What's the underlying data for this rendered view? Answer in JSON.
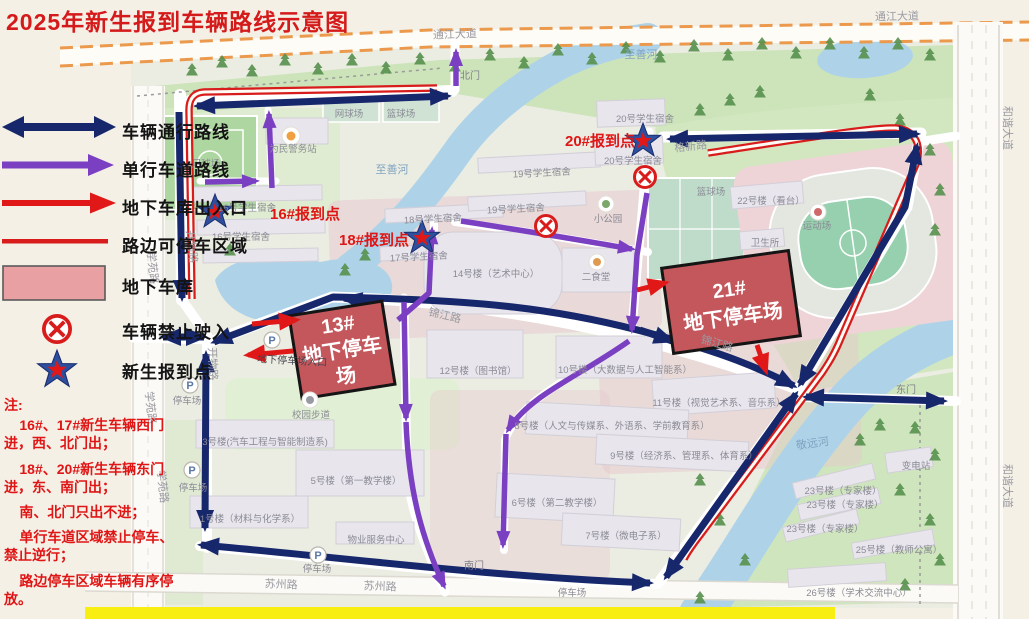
{
  "title": "2025年新生报到车辆路线示意图",
  "legend": {
    "items": [
      {
        "id": "two-way-route",
        "label": "车辆通行路线",
        "color": "#17276b"
      },
      {
        "id": "one-way-route",
        "label": "单行车道路线",
        "color": "#7b3fc2"
      },
      {
        "id": "garage-access",
        "label": "地下车库出入口",
        "color": "#e01818"
      },
      {
        "id": "roadside-parking",
        "label": "路边可停车区域",
        "color": "#d81c1c"
      },
      {
        "id": "underground-garage",
        "label": "地下车库",
        "color": "#e9a0a2"
      },
      {
        "id": "no-entry",
        "label": "车辆禁止驶入",
        "color": "#d81c1c"
      },
      {
        "id": "checkin-point",
        "label": "新生报到点",
        "color": "#2d4f9e"
      }
    ]
  },
  "notes": {
    "heading": "注:",
    "lines": [
      "16#、17#新生车辆西门进，西、北门出；",
      "18#、20#新生车辆东门进，东、南门出；",
      "南、北门只出不进；",
      "单行车道区域禁止停车、禁止逆行；",
      "路边停车区域车辆有序停放。"
    ]
  },
  "map": {
    "garages": [
      {
        "id": "garage-13",
        "lines": [
          "13#",
          "地下停车",
          "场"
        ],
        "x": 342,
        "y": 350,
        "rot": -9,
        "w": 94,
        "h": 84
      },
      {
        "id": "garage-21",
        "lines": [
          "21#",
          "地下停车场"
        ],
        "x": 731,
        "y": 302,
        "rot": -8,
        "w": 128,
        "h": 86
      }
    ],
    "checkin_stars": [
      {
        "id": "star-16",
        "x": 215,
        "y": 212
      },
      {
        "id": "star-18",
        "x": 422,
        "y": 238
      },
      {
        "id": "star-20",
        "x": 643,
        "y": 141
      }
    ],
    "no_entry": [
      {
        "id": "no-entry-1",
        "x": 546,
        "y": 226
      },
      {
        "id": "no-entry-2",
        "x": 645,
        "y": 177
      }
    ],
    "parking_icons": [
      [
        190,
        385
      ],
      [
        192,
        470
      ],
      [
        272,
        340
      ],
      [
        318,
        555
      ]
    ],
    "labels": [
      {
        "id": "road-tongjiang-1",
        "text": "通江大道",
        "x": 455,
        "y": 38,
        "rot": -2,
        "cls": "road"
      },
      {
        "id": "road-tongjiang-2",
        "text": "通江大道",
        "x": 897,
        "y": 20,
        "rot": -1,
        "cls": "road"
      },
      {
        "id": "road-hexie-1",
        "text": "和谐大道",
        "x": 1004,
        "y": 128,
        "rot": 90,
        "cls": "road"
      },
      {
        "id": "road-hexie-2",
        "text": "和谐大道",
        "x": 1004,
        "y": 486,
        "rot": 90,
        "cls": "road"
      },
      {
        "id": "road-xueyuan-1",
        "text": "学苑路",
        "x": 149,
        "y": 268,
        "rot": 84,
        "cls": "road"
      },
      {
        "id": "road-xueyuan-2",
        "text": "学苑路",
        "x": 147,
        "y": 408,
        "rot": 84,
        "cls": "road"
      },
      {
        "id": "road-xueyuan-3",
        "text": "学苑路",
        "x": 159,
        "y": 487,
        "rot": 84,
        "cls": "road"
      },
      {
        "id": "road-kaiwu-1",
        "text": "开物路",
        "x": 188,
        "y": 247,
        "rot": 84,
        "cls": "road"
      },
      {
        "id": "road-kaiwu-2",
        "text": "开物路",
        "x": 209,
        "y": 364,
        "rot": 88,
        "cls": "road"
      },
      {
        "id": "road-jinjiang-1",
        "text": "锦江路",
        "x": 444,
        "y": 319,
        "rot": 13,
        "cls": "road"
      },
      {
        "id": "road-jinjiang-2",
        "text": "锦江路",
        "x": 716,
        "y": 347,
        "rot": 16,
        "cls": "road"
      },
      {
        "id": "road-gexin",
        "text": "格新路",
        "x": 691,
        "y": 150,
        "rot": -6,
        "cls": "road"
      },
      {
        "id": "road-suzhou-1",
        "text": "苏州路",
        "x": 281,
        "y": 588,
        "rot": 2,
        "cls": "road"
      },
      {
        "id": "road-suzhou-2",
        "text": "苏州路",
        "x": 380,
        "y": 590,
        "rot": 2,
        "cls": "road"
      },
      {
        "id": "river-zhishan-1",
        "text": "至善河",
        "x": 392,
        "y": 173,
        "cls": "water"
      },
      {
        "id": "river-zhishan-2",
        "text": "至善河",
        "x": 641,
        "y": 58,
        "cls": "water"
      },
      {
        "id": "river-jingyuan",
        "text": "敬远河",
        "x": 813,
        "y": 447,
        "rot": -8,
        "cls": "water"
      },
      {
        "id": "gate-north",
        "text": "北门",
        "x": 470,
        "y": 79,
        "cls": "gate"
      },
      {
        "id": "gate-east",
        "text": "东门",
        "x": 906,
        "y": 393,
        "cls": "gate"
      },
      {
        "id": "gate-south",
        "text": "南门",
        "x": 474,
        "y": 569,
        "cls": "gate"
      },
      {
        "id": "pl-football",
        "text": "足球场",
        "x": 206,
        "y": 167,
        "cls": "place"
      },
      {
        "id": "pl-police",
        "text": "为民警务站",
        "x": 293,
        "y": 152,
        "cls": "place"
      },
      {
        "id": "pl-tennis",
        "text": "网球场",
        "x": 349,
        "y": 117,
        "cls": "place"
      },
      {
        "id": "pl-basket-1",
        "text": "篮球场",
        "x": 401,
        "y": 117,
        "cls": "place"
      },
      {
        "id": "pl-basket-2",
        "text": "篮球场",
        "x": 711,
        "y": 195,
        "cls": "place"
      },
      {
        "id": "pl-dorm16-1",
        "text": "16号学生宿舍",
        "x": 247,
        "y": 211,
        "cls": "place"
      },
      {
        "id": "pl-dorm16-2",
        "text": "16号学生宿舍",
        "x": 241,
        "y": 240,
        "cls": "place"
      },
      {
        "id": "pl-dorm18",
        "text": "18号学生宿舍",
        "x": 433,
        "y": 222,
        "rot": -3,
        "cls": "place"
      },
      {
        "id": "pl-dorm17",
        "text": "17号学生宿舍",
        "x": 419,
        "y": 260,
        "rot": -3,
        "cls": "place"
      },
      {
        "id": "pl-dorm19-1",
        "text": "19号学生宿舍",
        "x": 542,
        "y": 176,
        "rot": -3,
        "cls": "place"
      },
      {
        "id": "pl-dorm19-2",
        "text": "19号学生宿舍",
        "x": 516,
        "y": 212,
        "rot": -3,
        "cls": "place"
      },
      {
        "id": "pl-dorm20-1",
        "text": "20号学生宿舍",
        "x": 645,
        "y": 122,
        "cls": "place"
      },
      {
        "id": "pl-dorm20-2",
        "text": "20号学生宿舍",
        "x": 633,
        "y": 164,
        "cls": "place"
      },
      {
        "id": "pl-park-small",
        "text": "小公园",
        "x": 608,
        "y": 222,
        "cls": "place"
      },
      {
        "id": "pl-canteen2",
        "text": "二食堂",
        "x": 596,
        "y": 280,
        "cls": "place"
      },
      {
        "id": "pl-b14",
        "text": "14号楼（艺术中心）",
        "x": 496,
        "y": 277,
        "cls": "place"
      },
      {
        "id": "pl-b12",
        "text": "12号楼（图书馆）",
        "x": 478,
        "y": 374,
        "cls": "place"
      },
      {
        "id": "pl-b10",
        "text": "10号楼（大数据与人工智能系）",
        "x": 625,
        "y": 373,
        "cls": "place"
      },
      {
        "id": "pl-b11",
        "text": "11号楼（视觉艺术系、音乐系）",
        "x": 719,
        "y": 406,
        "cls": "place"
      },
      {
        "id": "pl-b8",
        "text": "8号楼（人文与传媒系、外语系、学前教育系）",
        "x": 612,
        "y": 429,
        "cls": "place"
      },
      {
        "id": "pl-b9",
        "text": "9号楼（经济系、管理系、体育系）",
        "x": 684,
        "y": 459,
        "cls": "place"
      },
      {
        "id": "pl-b6",
        "text": "6号楼（第二教学楼）",
        "x": 557,
        "y": 506,
        "cls": "place"
      },
      {
        "id": "pl-b7",
        "text": "7号楼（微电子系）",
        "x": 626,
        "y": 539,
        "cls": "place"
      },
      {
        "id": "pl-b5",
        "text": "5号楼（第一教学楼）",
        "x": 356,
        "y": 484,
        "cls": "place"
      },
      {
        "id": "pl-b3",
        "text": "3号楼(汽车工程与智能制造系)",
        "x": 265,
        "y": 445,
        "cls": "place"
      },
      {
        "id": "pl-b1",
        "text": "1号楼（材料与化学系）",
        "x": 250,
        "y": 522,
        "cls": "place"
      },
      {
        "id": "pl-property",
        "text": "物业服务中心",
        "x": 376,
        "y": 543,
        "cls": "place"
      },
      {
        "id": "pl-walkway",
        "text": "校园步道",
        "x": 311,
        "y": 418,
        "cls": "place"
      },
      {
        "id": "pl-b22",
        "text": "22号楼（看台）",
        "x": 771,
        "y": 204,
        "cls": "place"
      },
      {
        "id": "pl-stadium",
        "text": "运动场",
        "x": 817,
        "y": 229,
        "cls": "place"
      },
      {
        "id": "pl-clinic",
        "text": "卫生所",
        "x": 765,
        "y": 246,
        "cls": "place"
      },
      {
        "id": "pl-b23-1",
        "text": "23号楼（专家楼）",
        "x": 843,
        "y": 494,
        "cls": "place"
      },
      {
        "id": "pl-b23-2",
        "text": "23号楼（专家楼）",
        "x": 845,
        "y": 508,
        "cls": "place"
      },
      {
        "id": "pl-b23-3",
        "text": "23号楼（专家楼）",
        "x": 825,
        "y": 532,
        "cls": "place"
      },
      {
        "id": "pl-b25",
        "text": "25号楼（教师公寓）",
        "x": 899,
        "y": 553,
        "cls": "place"
      },
      {
        "id": "pl-b26",
        "text": "26号楼（学术交流中心）",
        "x": 859,
        "y": 596,
        "cls": "place"
      },
      {
        "id": "pl-substation",
        "text": "变电站",
        "x": 916,
        "y": 469,
        "cls": "place"
      },
      {
        "id": "pl-parking-1",
        "text": "停车场",
        "x": 187,
        "y": 404,
        "cls": "place"
      },
      {
        "id": "pl-parking-2",
        "text": "停车场",
        "x": 193,
        "y": 491,
        "cls": "place"
      },
      {
        "id": "pl-parking-3",
        "text": "停车场",
        "x": 317,
        "y": 572,
        "cls": "place"
      },
      {
        "id": "pl-parking-4",
        "text": "停车场",
        "x": 572,
        "y": 596,
        "cls": "place"
      },
      {
        "id": "checkin-16-label",
        "text": "16#报到点",
        "x": 305,
        "y": 219,
        "cls": "checkin"
      },
      {
        "id": "checkin-18-label",
        "text": "18#报到点",
        "x": 374,
        "y": 245,
        "cls": "checkin"
      },
      {
        "id": "checkin-20-label",
        "text": "20#报到点",
        "x": 600,
        "y": 146,
        "cls": "checkin"
      },
      {
        "id": "garage-entrance-label",
        "text": "地下停车场入口",
        "x": 292,
        "y": 364,
        "rot": 3,
        "cls": "small-dark"
      }
    ]
  }
}
